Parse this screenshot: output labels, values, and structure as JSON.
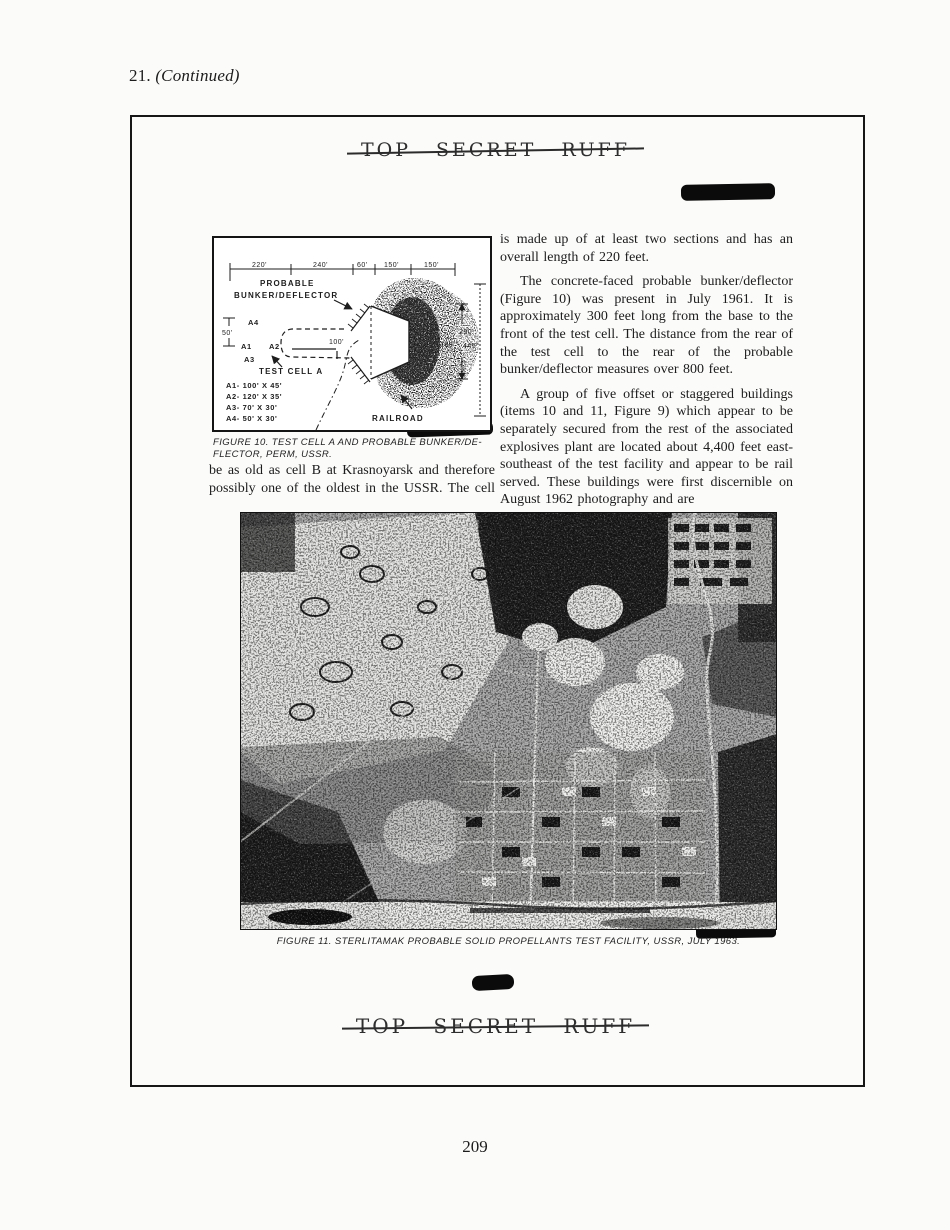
{
  "page": {
    "header_number": "21.",
    "header_continued": "(Continued)",
    "classification": "TOP SECRET RUFF",
    "page_number": "209"
  },
  "fig10": {
    "dims_top": [
      "220'",
      "240'",
      "60'",
      "150'",
      "150'"
    ],
    "probable_line1": "PROBABLE",
    "probable_line2": "BUNKER/DEFLECTOR",
    "dim_50": "50'",
    "label_a4": "A4",
    "label_a1": "A1",
    "label_a2": "A2",
    "label_a3": "A3",
    "label_test_cell": "TEST CELL A",
    "label_100": "100'",
    "legend": [
      "A1-  100' X 45'",
      "A2-  120' X 35'",
      "A3-   70' X 30'",
      "A4-   50' X 30'"
    ],
    "dim_290": "290'",
    "dim_160": "160'",
    "dim_445": "445'",
    "label_railroad": "RAILROAD",
    "caption_line1": "FIGURE 10.  TEST CELL A AND PROBABLE BUNKER/DE-",
    "caption_line2": "FLECTOR, PERM, USSR."
  },
  "columns": {
    "left": {
      "lines": [
        "be as old as cell B at Krasnoyarsk and therefore",
        "possibly one of the oldest in the USSR.  The cell"
      ]
    },
    "right": {
      "p1": "is made up of at least two sections and has an overall length of 220 feet.",
      "p2": "The concrete-faced probable bunker/deflector (Figure 10) was present in July 1961. It is approximately 300 feet long from the base to the front of the test cell. The distance from the rear of the test cell to the rear of the probable bunker/deflector measures over 800 feet.",
      "p3": "A group of five offset or staggered buildings (items 10 and 11, Figure 9) which appear to be separately secured from the rest of the associated explosives plant are located about 4,400 feet east-southeast of the test facility and appear to be rail served. These buildings were first discernible on August 1962 photography and are"
    }
  },
  "fig11": {
    "caption": "FIGURE 11.  STERLITAMAK PROBABLE SOLID PROPELLANTS TEST FACILITY, USSR, JULY 1963."
  },
  "colors": {
    "ink": "#1c1c1c",
    "redaction": "#0b0b0b",
    "paper": "#fbfbfa"
  }
}
